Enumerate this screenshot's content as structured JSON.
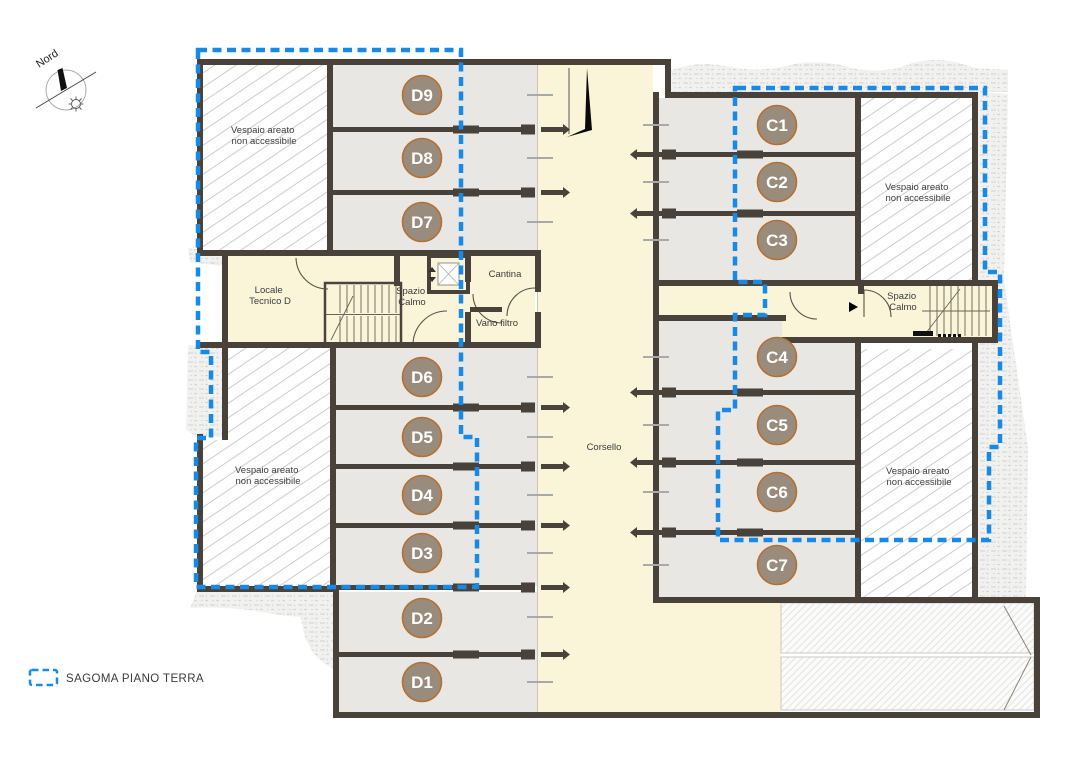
{
  "compass": {
    "label": "Nord"
  },
  "legend": {
    "label": "SAGOMA PIANO TERRA",
    "swatch_color": "#1789e6"
  },
  "colors": {
    "wall": "#49423a",
    "stall_fill": "#e8e7e4",
    "room_fill": "#faf4d9",
    "marker_fill": "#9a8c7d",
    "marker_ring": "#b5702f",
    "sagoma_blue": "#1789e6"
  },
  "rooms": {
    "vespaio_line1": "Vespaio areato",
    "vespaio_line2": "non accessibile",
    "locale_tecnico_line1": "Locale",
    "locale_tecnico_line2": "Tecnico D",
    "spazio_calmo_line1": "Spazio",
    "spazio_calmo_line2": "Calmo",
    "cantina": "Cantina",
    "vano_filtro": "Vano filtro",
    "corsello": "Corsello"
  },
  "stalls": {
    "d": [
      "D9",
      "D8",
      "D7",
      "D6",
      "D5",
      "D4",
      "D3",
      "D2",
      "D1"
    ],
    "c": [
      "C1",
      "C2",
      "C3",
      "C4",
      "C5",
      "C6",
      "C7"
    ]
  }
}
